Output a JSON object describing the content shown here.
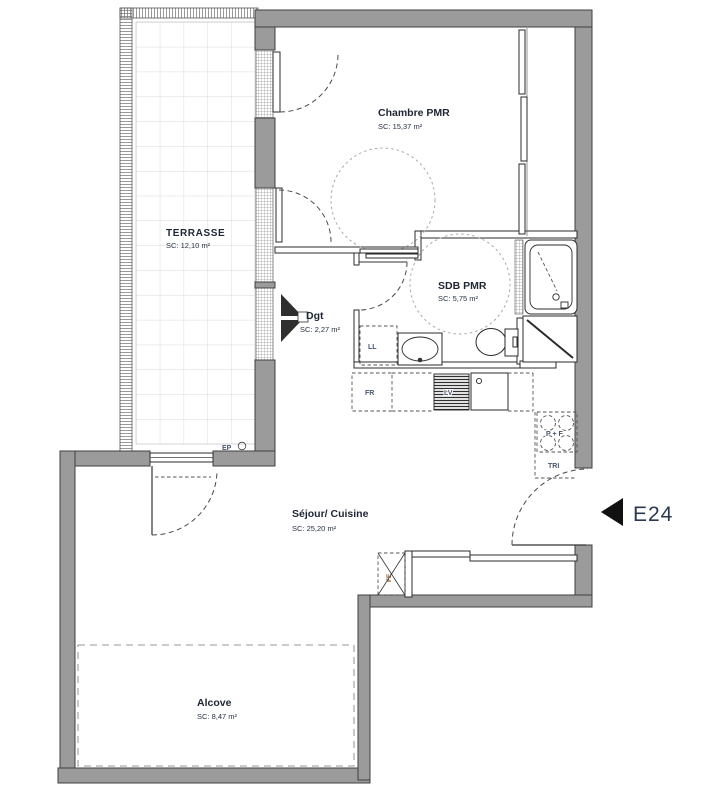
{
  "plan": {
    "marker": {
      "label": "E24"
    },
    "rooms": {
      "terrasse": {
        "name": "TERRASSE",
        "area": "SC: 12,10 m²"
      },
      "chambre": {
        "name": "Chambre PMR",
        "area": "SC: 15,37 m²"
      },
      "sdb": {
        "name": "SDB PMR",
        "area": "SC: 5,75 m²"
      },
      "dgt": {
        "name": "Dgt",
        "area": "SC: 2,27 m²"
      },
      "sejour": {
        "name": "Séjour/ Cuisine",
        "area": "SC: 25,20 m²"
      },
      "alcove": {
        "name": "Alcove",
        "area": "SC: 8,47 m²"
      }
    },
    "equipment": {
      "ll": "LL",
      "fr": "FR",
      "lv": "LV",
      "tri": "TRI",
      "hob": "P + F",
      "ep": "EP",
      "fe": "FE"
    },
    "colors": {
      "wall": "#9b9b9b",
      "partition_line": "#2b2b2b",
      "room_label": "#1e2533",
      "equipment_label": "#44556f",
      "marker_text": "#2a3950",
      "tile_line": "#cdcdcd"
    }
  }
}
